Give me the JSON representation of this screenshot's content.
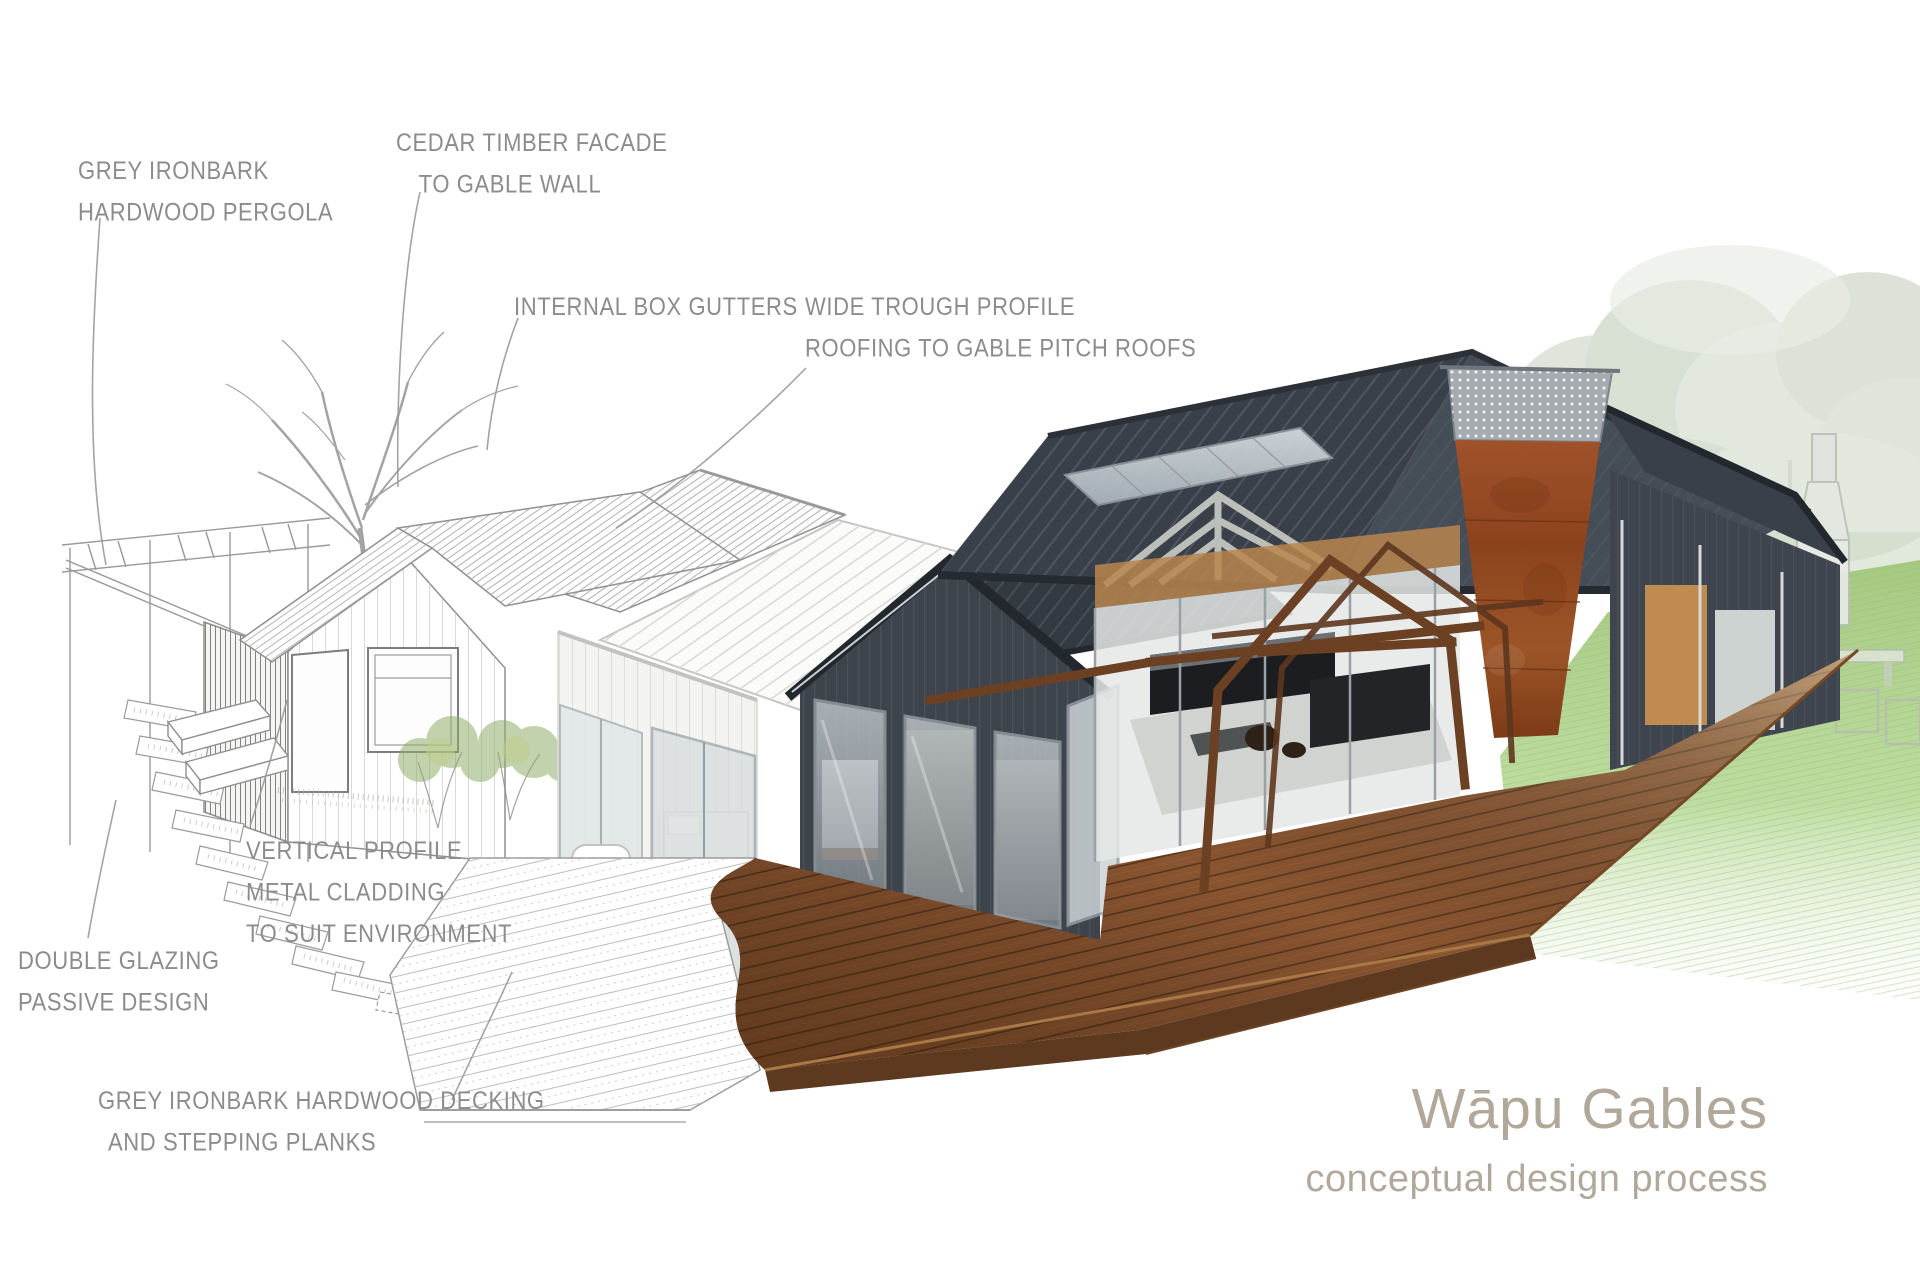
{
  "title_block": {
    "title": "Wāpu Gables",
    "subtitle": "conceptual design process"
  },
  "annotations": {
    "pergola": {
      "lines": [
        "GREY IRONBARK",
        "HARDWOOD PERGOLA"
      ]
    },
    "cedar": {
      "lines": [
        "CEDAR TIMBER FACADE",
        "TO GABLE WALL"
      ]
    },
    "gutters": {
      "lines": [
        "INTERNAL BOX GUTTERS"
      ]
    },
    "roofing": {
      "lines": [
        "WIDE TROUGH PROFILE",
        "ROOFING TO GABLE PITCH ROOFS"
      ]
    },
    "cladding": {
      "lines": [
        "VERTICAL PROFILE",
        "METAL CLADDING",
        "TO SUIT ENVIRONMENT"
      ]
    },
    "glazing": {
      "lines": [
        "DOUBLE GLAZING",
        "PASSIVE DESIGN"
      ]
    },
    "decking": {
      "lines": [
        "GREY IRONBARK HARDWOOD DECKING",
        "AND STEPPING PLANKS"
      ]
    }
  },
  "colors": {
    "background": "#ffffff",
    "annotation_text": "#8c8c8c",
    "leader_line": "#9a9a9a",
    "title_text": "#b1a89a",
    "sketch_line": "#8f8f8f",
    "roof_dark": "#3a4049",
    "cladding_dark": "#3e444c",
    "corten_rust": "#9c5527",
    "deck_timber": "#8a5531",
    "pergola_timber": "#6b4023",
    "lawn_green": "#a6c981",
    "glass": "#bfc7ca"
  }
}
